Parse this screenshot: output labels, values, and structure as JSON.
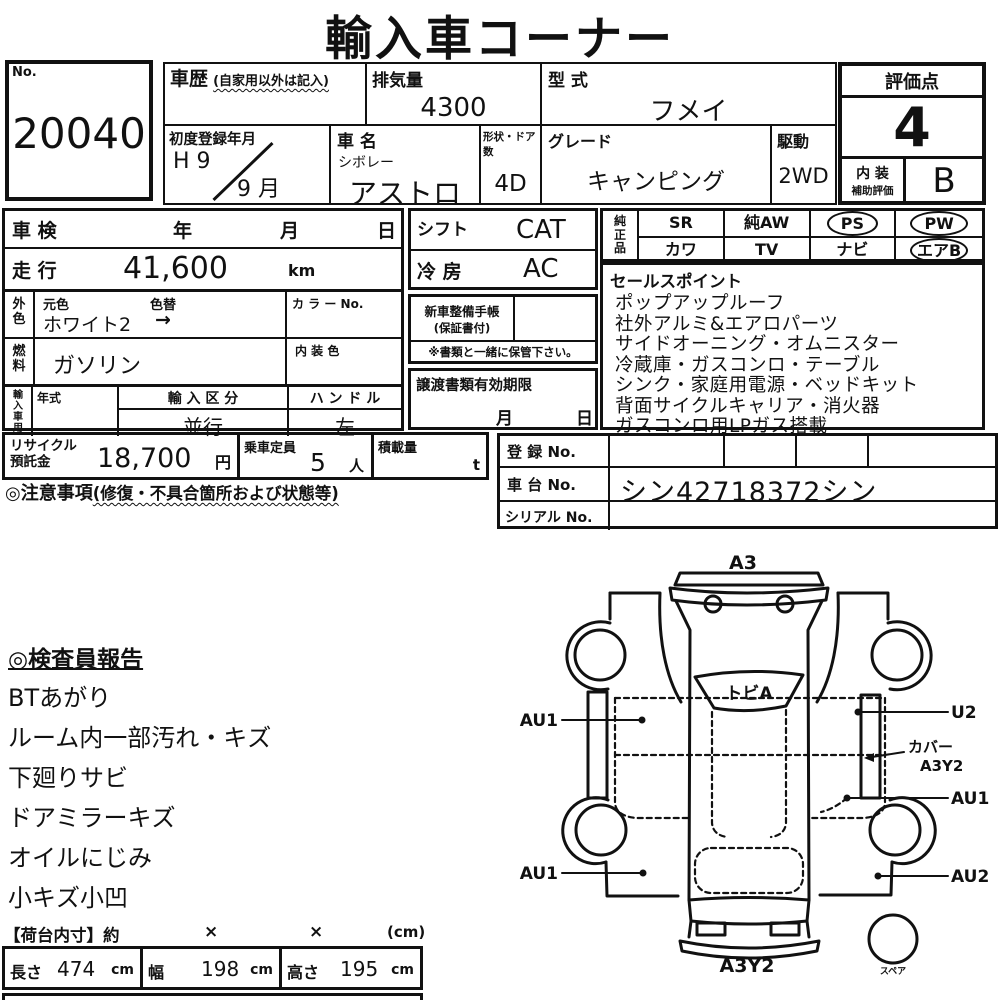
{
  "title": "輸入車コーナー",
  "no_box": {
    "label": "No.",
    "value": "20040"
  },
  "header": {
    "history": {
      "label": "車歴",
      "note": "(自家用以外は記入)"
    },
    "displacement": {
      "label": "排気量",
      "value": "4300"
    },
    "model_code": {
      "label": "型 式",
      "value": "フメイ"
    },
    "first_registration": {
      "label": "初度登録年月",
      "era_year": "H 9",
      "month": "9 月"
    },
    "car_name": {
      "label": "車 名",
      "maker": "シボレー",
      "value": "アストロ"
    },
    "body_doors": {
      "label": "形状・ドア数",
      "value": "4D"
    },
    "grade": {
      "label": "グレード",
      "value": "キャンピング"
    },
    "drive": {
      "label": "駆動",
      "value": "2WD"
    },
    "score": {
      "label": "評価点",
      "value": "4"
    },
    "interior": {
      "label_line1": "内 装",
      "label_line2": "補助評価",
      "value": "B"
    }
  },
  "left_panel": {
    "shaken": {
      "label": "車 検",
      "year": "年",
      "month": "月",
      "day": "日"
    },
    "mileage": {
      "label": "走 行",
      "value": "41,600",
      "unit": "km"
    },
    "exterior_color": {
      "label_line1": "外",
      "label_line2": "色",
      "orig_label": "元色",
      "change_label": "色替",
      "value": "ホワイト2",
      "arrow": "→",
      "color_no_label": "カ ラ ー No."
    },
    "fuel": {
      "label_line1": "燃",
      "label_line2": "料",
      "value": "ガソリン",
      "interior_color_label": "内 装 色"
    },
    "import": {
      "label_chars": "輸入車用",
      "c1": "輸",
      "c2": "入",
      "c3": "車",
      "c4": "用",
      "year_label": "年式",
      "class_label": "輸 入 区 分",
      "class_value": "並行",
      "handle_label": "ハ ン ド ル",
      "handle_value": "左"
    }
  },
  "mid_panel": {
    "shift": {
      "label": "シフト",
      "value": "CAT"
    },
    "cooling": {
      "label": "冷 房",
      "value": "AC"
    },
    "service_book": {
      "label": "新車整備手帳",
      "note": "(保証書付)",
      "keep_note": "※書類と一緒に保管下さい。"
    },
    "transfer_docs": {
      "label": "譲渡書類有効期限",
      "month": "月",
      "day": "日"
    }
  },
  "equipment": {
    "c1": "純",
    "c2": "正",
    "c3": "品",
    "cells": [
      {
        "label": "SR",
        "circled": false
      },
      {
        "label": "純AW",
        "circled": false
      },
      {
        "label": "PS",
        "circled": true
      },
      {
        "label": "PW",
        "circled": true
      },
      {
        "label": "カワ",
        "circled": false
      },
      {
        "label": "TV",
        "circled": false
      },
      {
        "label": "ナビ",
        "circled": false
      },
      {
        "label": "エアB",
        "circled": true
      }
    ]
  },
  "sales_points": {
    "title": "セールスポイント",
    "items": [
      "ポップアップルーフ",
      "社外アルミ&エアロパーツ",
      "サイドオーニング・オムニスター",
      "冷蔵庫・ガスコンロ・テーブル",
      "シンク・家庭用電源・ベッドキット",
      "背面サイクルキャリア・消火器",
      "ガスコンロ用LPガス搭載"
    ]
  },
  "recycle_row": {
    "recycle": {
      "label_line1": "リサイクル",
      "label_line2": "預託金",
      "value": "18,700",
      "unit": "円"
    },
    "capacity": {
      "label": "乗車定員",
      "value": "5",
      "unit": "人"
    },
    "load": {
      "label": "積載量",
      "unit": "t"
    }
  },
  "registration": {
    "reg_no_label": "登 録 No.",
    "chassis_no_label": "車 台 No.",
    "chassis_no_value": "シン42718372シン",
    "serial_no_label": "シリアル No."
  },
  "caution": {
    "label": "◎注意事項",
    "note": "(修復・不具合箇所および状態等)"
  },
  "inspector": {
    "title": "◎検査員報告",
    "items": [
      "BTあがり",
      "ルーム内一部汚れ・キズ",
      "下廻りサビ",
      "ドアミラーキズ",
      "オイルにじみ",
      "小キズ小凹"
    ]
  },
  "diagram": {
    "top": "A3",
    "glass": "トビA",
    "left_upper": "AU1",
    "left_lower": "AU1",
    "right_upper": "U2",
    "cover_line1": "カバー",
    "cover_line2": "A3Y2",
    "right_mid": "AU1",
    "right_lower": "AU2",
    "bottom": "A3Y2",
    "spare": "スペア"
  },
  "cargo": {
    "header": "【荷台内寸】約",
    "times1": "×",
    "times2": "×",
    "unit_note": "(cm)",
    "cells": [
      {
        "label": "長さ",
        "value": "474",
        "unit": "cm"
      },
      {
        "label": "幅",
        "value": "198",
        "unit": "cm"
      },
      {
        "label": "高さ",
        "value": "195",
        "unit": "cm"
      }
    ]
  }
}
